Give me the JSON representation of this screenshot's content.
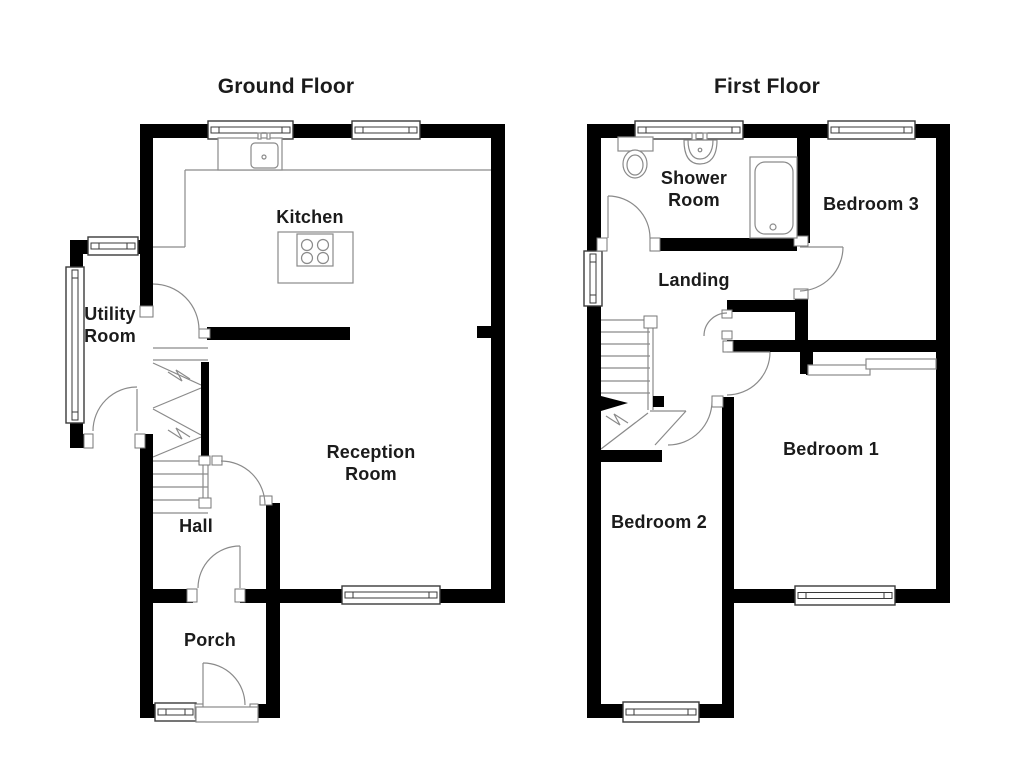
{
  "page_title": "Floor Plan",
  "titles": {
    "ground": "Ground Floor",
    "first": "First Floor"
  },
  "labels": [
    {
      "name": "ground-floor-title",
      "text": "Ground Floor",
      "x": 286,
      "y": 87,
      "size": 21
    },
    {
      "name": "first-floor-title",
      "text": "First Floor",
      "x": 767,
      "y": 87,
      "size": 21
    },
    {
      "name": "room-label-kitchen",
      "text": "Kitchen",
      "x": 310,
      "y": 218,
      "size": 18
    },
    {
      "name": "room-label-utility",
      "text": "Utility\nRoom",
      "x": 110,
      "y": 326,
      "size": 18
    },
    {
      "name": "room-label-reception",
      "text": "Reception\nRoom",
      "x": 371,
      "y": 464,
      "size": 18
    },
    {
      "name": "room-label-hall",
      "text": "Hall",
      "x": 196,
      "y": 527,
      "size": 18
    },
    {
      "name": "room-label-porch",
      "text": "Porch",
      "x": 210,
      "y": 641,
      "size": 18
    },
    {
      "name": "room-label-shower",
      "text": "Shower\nRoom",
      "x": 694,
      "y": 190,
      "size": 18
    },
    {
      "name": "room-label-bedroom3",
      "text": "Bedroom 3",
      "x": 871,
      "y": 205,
      "size": 18
    },
    {
      "name": "room-label-landing",
      "text": "Landing",
      "x": 694,
      "y": 281,
      "size": 18
    },
    {
      "name": "room-label-bedroom1",
      "text": "Bedroom 1",
      "x": 831,
      "y": 450,
      "size": 18
    },
    {
      "name": "room-label-bedroom2",
      "text": "Bedroom 2",
      "x": 659,
      "y": 523,
      "size": 18
    }
  ],
  "floorplan": {
    "colors": {
      "wall": "#000000",
      "line": "#8a8a8a",
      "window": "#3a3a3a",
      "fixture": "#8a8a8a",
      "bg": "#ffffff"
    },
    "lines": [
      [
        185,
        170,
        491,
        170
      ],
      [
        185,
        170,
        185,
        247
      ],
      [
        153,
        247,
        185,
        247
      ],
      [
        222,
        144,
        247,
        144
      ],
      [
        222,
        149,
        247,
        149
      ],
      [
        222,
        154,
        247,
        154
      ],
      [
        222,
        159,
        247,
        159
      ],
      [
        222,
        164,
        247,
        164
      ],
      [
        153,
        348,
        208,
        348
      ],
      [
        153,
        360,
        208,
        360
      ],
      [
        153,
        363,
        201,
        385
      ],
      [
        153,
        408,
        201,
        388
      ],
      [
        153,
        409,
        201,
        435
      ],
      [
        153,
        457,
        201,
        437
      ],
      [
        153,
        461,
        208,
        461
      ],
      [
        153,
        474,
        208,
        474
      ],
      [
        153,
        487,
        208,
        487
      ],
      [
        153,
        500,
        208,
        500
      ],
      [
        153,
        513,
        208,
        513
      ],
      [
        203,
        461,
        203,
        500
      ],
      [
        208,
        461,
        208,
        500
      ],
      [
        759,
        168,
        771,
        224
      ],
      [
        787,
        168,
        776,
        224
      ],
      [
        601,
        320,
        650,
        320
      ],
      [
        601,
        332,
        650,
        332
      ],
      [
        601,
        344,
        650,
        344
      ],
      [
        601,
        356,
        650,
        356
      ],
      [
        601,
        368,
        650,
        368
      ],
      [
        601,
        381,
        650,
        381
      ],
      [
        601,
        393,
        650,
        393
      ],
      [
        648,
        318,
        648,
        410
      ],
      [
        653,
        318,
        653,
        410
      ],
      [
        601,
        449,
        648,
        413
      ],
      [
        686,
        411,
        655,
        445
      ],
      [
        650,
        411,
        686,
        411
      ]
    ],
    "walls": [
      [
        140,
        124,
        365,
        14
      ],
      [
        491,
        124,
        14,
        479
      ],
      [
        266,
        589,
        239,
        14
      ],
      [
        153,
        589,
        40,
        14
      ],
      [
        240,
        589,
        26,
        14
      ],
      [
        140,
        124,
        13,
        126
      ],
      [
        140,
        250,
        13,
        65
      ],
      [
        140,
        434,
        13,
        284
      ],
      [
        266,
        503,
        14,
        215
      ],
      [
        70,
        240,
        82,
        14
      ],
      [
        70,
        240,
        13,
        208
      ],
      [
        70,
        434,
        20,
        14
      ],
      [
        137,
        434,
        16,
        14
      ],
      [
        207,
        327,
        143,
        13
      ],
      [
        477,
        326,
        16,
        12
      ],
      [
        140,
        704,
        58,
        14
      ],
      [
        258,
        704,
        22,
        14
      ],
      [
        201,
        362,
        8,
        98
      ],
      [
        587,
        124,
        363,
        14
      ],
      [
        587,
        124,
        14,
        594
      ],
      [
        936,
        124,
        14,
        479
      ],
      [
        655,
        238,
        142,
        13
      ],
      [
        797,
        124,
        13,
        119
      ],
      [
        795,
        293,
        13,
        52
      ],
      [
        727,
        300,
        70,
        12
      ],
      [
        727,
        340,
        223,
        12
      ],
      [
        800,
        351,
        13,
        23
      ],
      [
        722,
        397,
        12,
        313
      ],
      [
        734,
        589,
        216,
        14
      ],
      [
        587,
        704,
        147,
        14
      ],
      [
        595,
        450,
        67,
        12
      ],
      [
        653,
        396,
        11,
        11
      ],
      [
        806,
        366,
        8,
        9
      ],
      [
        929,
        360,
        8,
        9
      ]
    ],
    "windows": [
      [
        208,
        121,
        85,
        18
      ],
      [
        352,
        121,
        68,
        18
      ],
      [
        88,
        237,
        50,
        18
      ],
      [
        66,
        267,
        18,
        156
      ],
      [
        342,
        586,
        98,
        18
      ],
      [
        155,
        703,
        41,
        18
      ],
      [
        635,
        121,
        108,
        18
      ],
      [
        828,
        121,
        87,
        18
      ],
      [
        584,
        251,
        18,
        55
      ],
      [
        795,
        586,
        100,
        19
      ],
      [
        623,
        702,
        76,
        20
      ]
    ],
    "wardrobes": [
      [
        808,
        365,
        62,
        10
      ],
      [
        866,
        359,
        70,
        10
      ]
    ],
    "frames": [
      [
        140,
        306,
        13,
        11
      ],
      [
        84,
        434,
        9,
        14
      ],
      [
        135,
        434,
        10,
        14
      ],
      [
        212,
        456,
        10,
        9
      ],
      [
        260,
        496,
        12,
        9
      ],
      [
        187,
        589,
        10,
        13
      ],
      [
        235,
        589,
        10,
        13
      ],
      [
        195,
        704,
        8,
        14
      ],
      [
        250,
        704,
        8,
        14
      ],
      [
        199,
        329,
        11,
        9
      ],
      [
        199,
        456,
        11,
        9
      ],
      [
        199,
        498,
        12,
        10
      ],
      [
        597,
        238,
        10,
        13
      ],
      [
        650,
        238,
        10,
        13
      ],
      [
        794,
        236,
        14,
        10
      ],
      [
        794,
        289,
        14,
        10
      ],
      [
        723,
        341,
        10,
        11
      ],
      [
        712,
        396,
        11,
        11
      ],
      [
        722,
        310,
        10,
        8
      ],
      [
        722,
        331,
        10,
        8
      ],
      [
        644,
        316,
        13,
        12
      ]
    ],
    "door_paths": [
      "M153,284 A46,46 0 0 1 199,330",
      "M137,389 L137,431",
      "M93,431 A44,44 0 0 1 137,387",
      "M221,461 A44,44 0 0 1 265,505",
      "M240,546 L240,588",
      "M198,588 A42,42 0 0 1 240,546",
      "M203,663 L203,705",
      "M203,663 A42,42 0 0 1 245,705",
      "M608,196 L608,238",
      "M608,196 A42,42 0 0 1 650,238",
      "M800,247 L843,247",
      "M843,247 A44,44 0 0 1 800,291",
      "M727,352 L770,352",
      "M770,352 A43,43 0 0 1 727,395",
      "M712,401 A44,44 0 0 1 668,445",
      "M727,313 A23,23 0 0 0 704,336",
      "M168,372 L182,381 L176,370 L190,379",
      "M168,430 L182,439 L176,428 L190,437",
      "M606,416 L620,425 L614,414 L628,423"
    ],
    "black_paths": [
      "M601,396 L601,411 L628,403 Z"
    ],
    "fixture_rects": [
      [
        218,
        138,
        64,
        32,
        0
      ],
      [
        251,
        143,
        27,
        25,
        4
      ],
      [
        258,
        133,
        3,
        6,
        0
      ],
      [
        267,
        133,
        3,
        6,
        0
      ],
      [
        278,
        232,
        75,
        51,
        0
      ],
      [
        297,
        234,
        36,
        32,
        0
      ],
      [
        618,
        137,
        35,
        14,
        0
      ],
      [
        692,
        133,
        4,
        7,
        0
      ],
      [
        703,
        133,
        4,
        7,
        0
      ],
      [
        750,
        157,
        47,
        81,
        0
      ],
      [
        755,
        162,
        38,
        72,
        10
      ],
      [
        196,
        707,
        62,
        15,
        0
      ]
    ],
    "fixture_paths": [
      "M684,140 L717,140 C717,157 710,164 700,164 C690,164 684,157 684,140 Z",
      "M688,140 C688,153 693,159 700,159 C707,159 713,153 713,140"
    ],
    "fixture_circles": [
      [
        307,
        245,
        5.5
      ],
      [
        323,
        245,
        5.5
      ],
      [
        307,
        258,
        5.5
      ],
      [
        323,
        258,
        5.5
      ],
      [
        264,
        157,
        2
      ],
      [
        773,
        227,
        3
      ],
      [
        700,
        150,
        1.8
      ]
    ],
    "fixture_ellipses": [
      [
        635,
        164,
        12,
        14
      ],
      [
        635,
        165,
        8,
        10
      ]
    ]
  }
}
